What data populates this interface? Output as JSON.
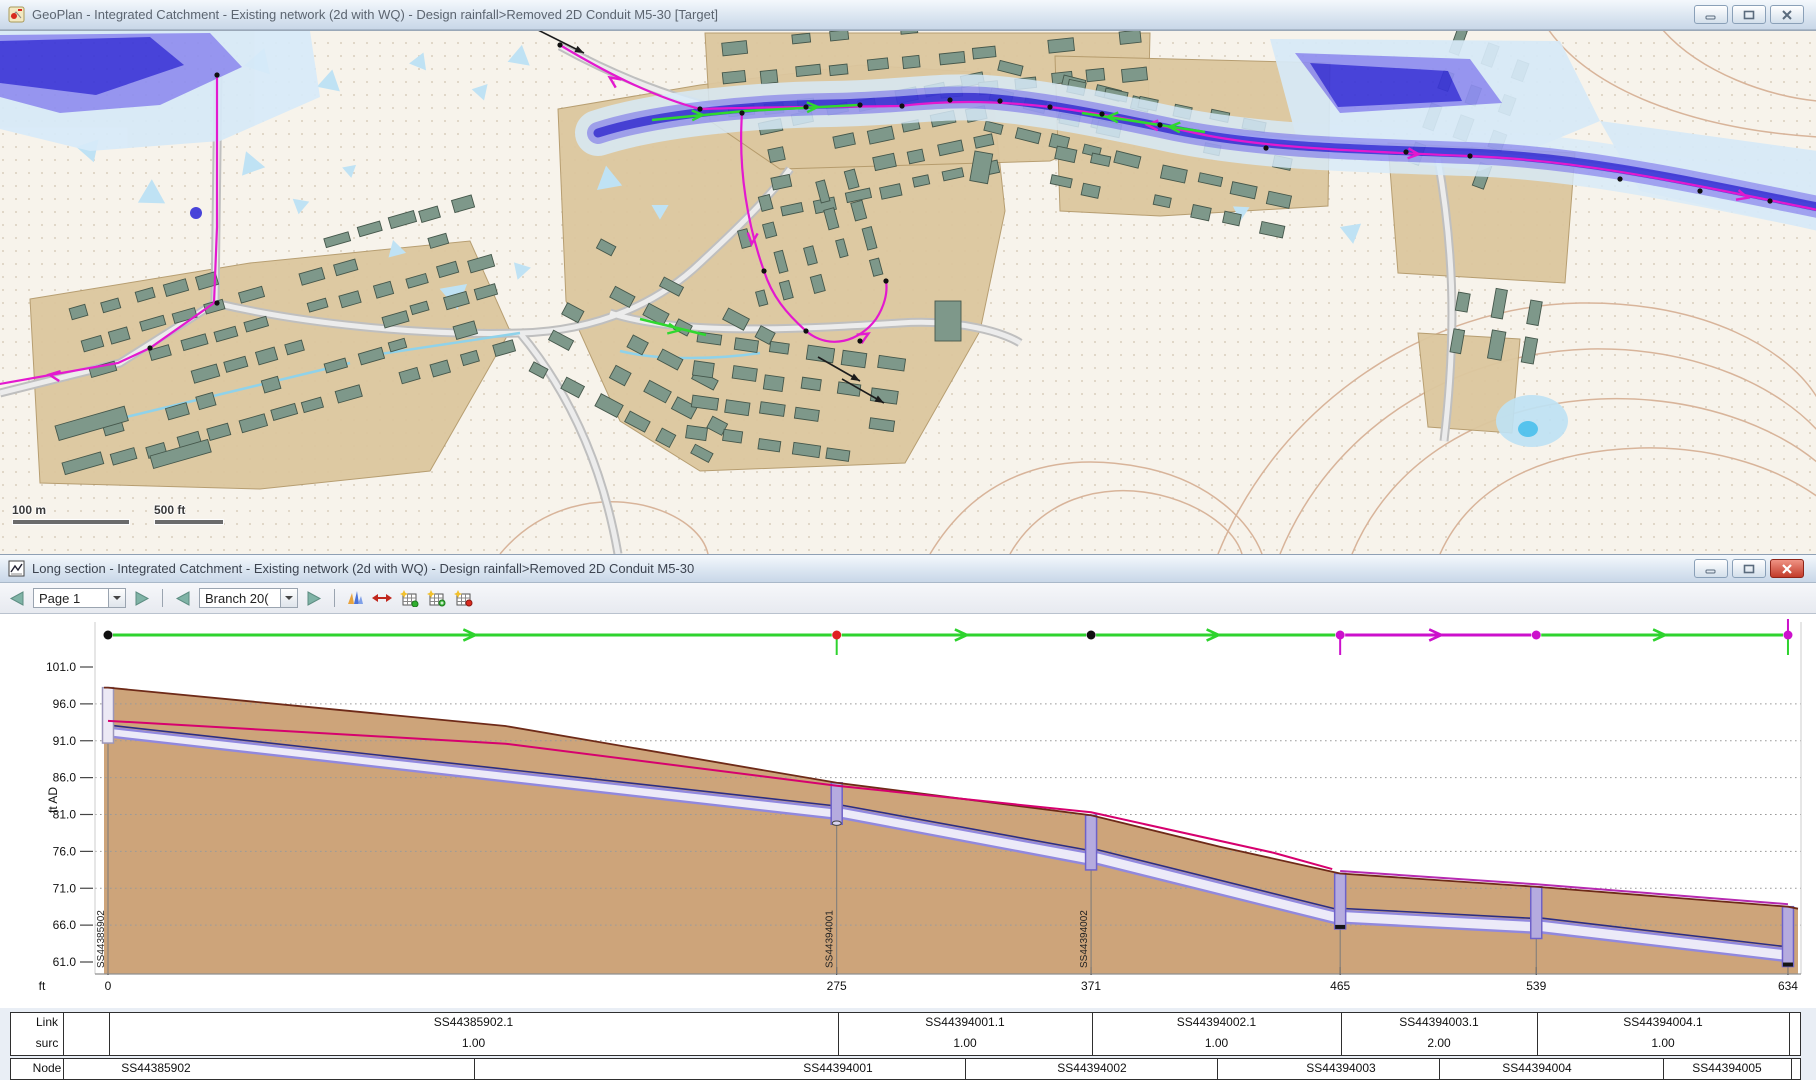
{
  "windows": {
    "geoplan": {
      "title": "GeoPlan - Integrated Catchment - Existing network (2d with WQ) - Design rainfall>Removed 2D Conduit M5-30  [Target]",
      "scale_bar": {
        "metric_label": "100 m",
        "imperial_label": "500 ft"
      }
    },
    "long_section": {
      "title": "Long section - Integrated Catchment - Existing network (2d with WQ) - Design rainfall>Removed 2D Conduit M5-30",
      "toolbar": {
        "page_value": "Page 1",
        "branch_value": "Branch 20("
      }
    }
  },
  "chart_data": {
    "type": "line",
    "title": "Long section profile",
    "ylabel": "ft AD",
    "x_axis_unit_label": "ft",
    "ylim": [
      61.0,
      101.0
    ],
    "xlim": [
      0,
      634
    ],
    "grid": "horizontal-dotted",
    "y_tick_labels": [
      "101.0",
      "96.0",
      "91.0",
      "86.0",
      "81.0",
      "76.0",
      "71.0",
      "66.0",
      "61.0"
    ],
    "x_ticks": [
      0,
      275,
      371,
      465,
      539,
      634
    ],
    "nodes": [
      {
        "id": "SS44385902",
        "chainage_ft": 0,
        "ground_ft": 98.2,
        "invert_ft": 91.5,
        "marker_color": "#111111",
        "vertical_label": true
      },
      {
        "id": "SS44394001",
        "chainage_ft": 275,
        "ground_ft": 85.3,
        "invert_ft": 80.5,
        "marker_color": "#e02020",
        "vertical_label": true,
        "tick_below": "#2ed32e"
      },
      {
        "id": "SS44394002",
        "chainage_ft": 371,
        "ground_ft": 80.9,
        "invert_ft": 74.3,
        "marker_color": "#111111",
        "vertical_label": true
      },
      {
        "id": "SS44394003",
        "chainage_ft": 465,
        "ground_ft": 73.0,
        "invert_ft": 66.3,
        "marker_color": "#cc10cc",
        "tick_below": "#cc10cc"
      },
      {
        "id": "SS44394004",
        "chainage_ft": 539,
        "ground_ft": 71.2,
        "invert_ft": 65.0,
        "marker_color": "#cc10cc"
      },
      {
        "id": "SS44394005",
        "chainage_ft": 634,
        "ground_ft": 68.5,
        "invert_ft": 61.2,
        "marker_color": "#cc10cc",
        "tick_above": "#cc10cc",
        "tick_below": "#2ed32e"
      }
    ],
    "links": [
      {
        "id": "SS44385902.1",
        "surcharge": "1.00",
        "from_ft": 0,
        "to_ft": 275,
        "arrow": "green"
      },
      {
        "id": "SS44394001.1",
        "surcharge": "1.00",
        "from_ft": 275,
        "to_ft": 371,
        "arrow": "green"
      },
      {
        "id": "SS44394002.1",
        "surcharge": "1.00",
        "from_ft": 371,
        "to_ft": 465,
        "arrow": "green"
      },
      {
        "id": "SS44394003.1",
        "surcharge": "2.00",
        "from_ft": 465,
        "to_ft": 539,
        "arrow": "magenta"
      },
      {
        "id": "SS44394004.1",
        "surcharge": "1.00",
        "from_ft": 539,
        "to_ft": 634,
        "arrow": "green"
      }
    ],
    "series": [
      {
        "name": "ground-surface",
        "color": "#6e2a18",
        "x": [
          0,
          75,
          150,
          275,
          371,
          420,
          465,
          539,
          634
        ],
        "y": [
          98.2,
          95.6,
          93.0,
          85.3,
          80.9,
          76.6,
          73.0,
          71.2,
          68.5
        ]
      },
      {
        "name": "max-water-level",
        "color": "#d6006e",
        "x": [
          0,
          150,
          275,
          371,
          440,
          462
        ],
        "y": [
          93.7,
          90.6,
          84.9,
          81.3,
          75.8,
          73.6
        ]
      },
      {
        "name": "pipe-soffit",
        "color": "#2b2d85",
        "x": [
          0,
          275,
          371,
          465,
          539,
          634
        ],
        "y": [
          92.7,
          81.9,
          75.9,
          67.9,
          66.6,
          62.8
        ]
      },
      {
        "name": "pipe-invert",
        "color": "#9188de",
        "x": [
          0,
          275,
          371,
          465,
          539,
          634
        ],
        "y": [
          91.5,
          80.5,
          74.3,
          66.3,
          65.0,
          61.2
        ]
      }
    ],
    "status_colors": {
      "green": "#2ed32e",
      "magenta": "#cc10cc",
      "surcharge_red": "#e02020"
    }
  },
  "table": {
    "row_labels": [
      "Link",
      "surc",
      "Node"
    ],
    "link_row": [
      "SS44385902.1",
      "SS44394001.1",
      "SS44394002.1",
      "SS44394003.1",
      "SS44394004.1"
    ],
    "surc_row": [
      "1.00",
      "1.00",
      "1.00",
      "2.00",
      "1.00"
    ],
    "node_row": [
      "SS44385902",
      "SS44394001",
      "SS44394002",
      "SS44394003",
      "SS44394004",
      "SS44394005"
    ]
  }
}
